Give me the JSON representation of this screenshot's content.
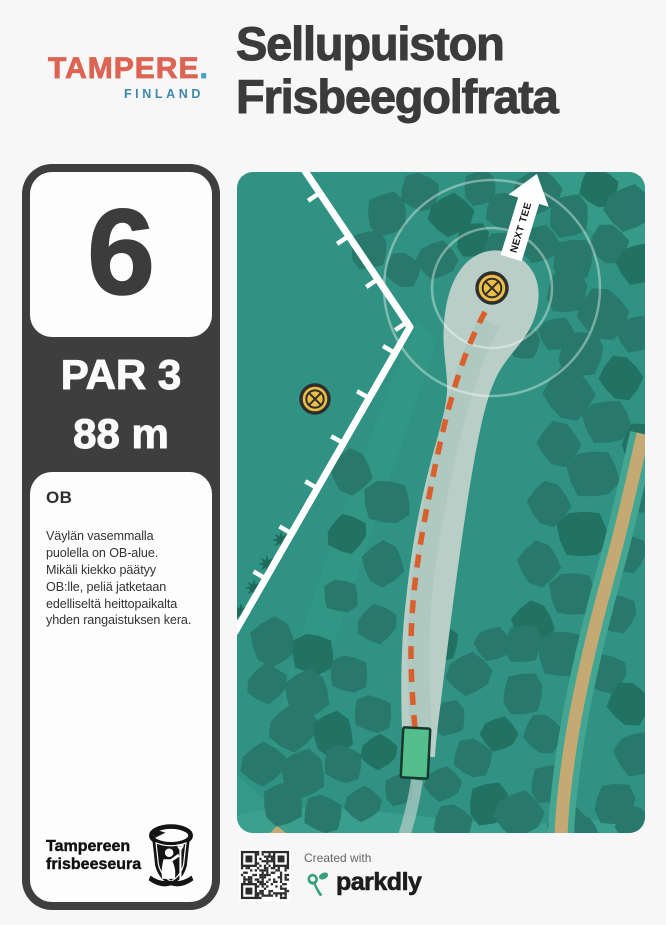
{
  "header": {
    "logo": {
      "wordmark": "TAMPERE",
      "dot": ".",
      "subtitle": "FINLAND",
      "wordmark_color": "#DD6453",
      "dot_color": "#46A0C6",
      "subtitle_color": "#3E88AE"
    },
    "title": "Sellupuiston\nFrisbeegolfrata"
  },
  "hole": {
    "number": "6",
    "par": "PAR 3",
    "distance": "88 m"
  },
  "ob": {
    "heading": "OB",
    "body": "Väylän vasemmalla\npuolella on OB-alue.\nMikäli kiekko päätyy\nOB:lle, peliä jatketaan\nedelliseltä heittopaikalta\nyhden rangaistuksen kera."
  },
  "club": {
    "name": "Tampereen\nfrisbeeseura"
  },
  "footer": {
    "created_with": "Created with",
    "brand": "parkdly",
    "brand_color": "#3BA07E"
  },
  "map": {
    "next_tee_label": "NEXT TEE",
    "colors": {
      "bg": "#2F9282",
      "wash": "#3EA190",
      "tree": "#28796B",
      "tree_dark": "#227263",
      "conifer": "#1D6A5B",
      "fairway": "#B8CEC7",
      "fairway_shade": "#A8C2B9",
      "path_tan": "#C5A972",
      "path_edge": "#43A693",
      "ob_line": "#FFFFFF",
      "flight": "#D9602C",
      "basket_fill": "#EDBE45",
      "basket_ring": "#2E2E2E",
      "tee_fill": "#55BE8D",
      "tee_stroke": "#17382C",
      "ring_stroke": "rgba(255,255,255,0.38)"
    },
    "washes": [
      {
        "d": "M 298 0 L 408 0 L 408 102 C 366 74 328 36 298 0 Z",
        "o": 0.5
      },
      {
        "d": "M 180 148 L 199 170 L 74 540 L 32 584 C 48 494 124 282 180 148 Z",
        "o": 0.28
      },
      {
        "d": "M 238 86 C 254 58 272 38 294 20 L 306 34 C 288 54 272 78 264 98 Z",
        "o": 0.3
      },
      {
        "d": "M -6 646 C 60 624 150 642 240 650 C 320 656 380 642 414 648 L 414 667 L -6 667 Z",
        "o": 0.75
      },
      {
        "d": "M -6 598 C 20 618 44 642 58 667 L -6 667 Z",
        "o": 0.45
      }
    ],
    "trees": [
      [
        150,
        42,
        22
      ],
      [
        183,
        20,
        20
      ],
      [
        214,
        43,
        22
      ],
      [
        243,
        16,
        18
      ],
      [
        268,
        40,
        20
      ],
      [
        300,
        20,
        24
      ],
      [
        332,
        44,
        22
      ],
      [
        362,
        16,
        20
      ],
      [
        392,
        36,
        24
      ],
      [
        132,
        78,
        20
      ],
      [
        166,
        98,
        18
      ],
      [
        200,
        88,
        20
      ],
      [
        236,
        68,
        18
      ],
      [
        266,
        82,
        22
      ],
      [
        302,
        72,
        20
      ],
      [
        336,
        88,
        22
      ],
      [
        372,
        72,
        20
      ],
      [
        402,
        92,
        22
      ],
      [
        330,
        120,
        22
      ],
      [
        366,
        142,
        26
      ],
      [
        400,
        162,
        20
      ],
      [
        344,
        182,
        24
      ],
      [
        384,
        206,
        22
      ],
      [
        320,
        162,
        18
      ],
      [
        288,
        172,
        16
      ],
      [
        332,
        222,
        26
      ],
      [
        370,
        250,
        24
      ],
      [
        404,
        270,
        20
      ],
      [
        322,
        272,
        22
      ],
      [
        356,
        302,
        26
      ],
      [
        398,
        322,
        20
      ],
      [
        312,
        332,
        22
      ],
      [
        346,
        362,
        26
      ],
      [
        390,
        382,
        20
      ],
      [
        302,
        392,
        22
      ],
      [
        336,
        422,
        24
      ],
      [
        380,
        442,
        20
      ],
      [
        296,
        452,
        22
      ],
      [
        326,
        482,
        26
      ],
      [
        370,
        502,
        20
      ],
      [
        114,
        300,
        22
      ],
      [
        150,
        330,
        24
      ],
      [
        110,
        362,
        20
      ],
      [
        146,
        392,
        22
      ],
      [
        104,
        424,
        18
      ],
      [
        140,
        452,
        20
      ],
      [
        36,
        470,
        24
      ],
      [
        76,
        482,
        22
      ],
      [
        30,
        512,
        20
      ],
      [
        70,
        522,
        24
      ],
      [
        112,
        502,
        20
      ],
      [
        56,
        556,
        24
      ],
      [
        96,
        562,
        22
      ],
      [
        136,
        542,
        20
      ],
      [
        26,
        592,
        22
      ],
      [
        66,
        602,
        24
      ],
      [
        106,
        592,
        20
      ],
      [
        142,
        580,
        18
      ],
      [
        46,
        632,
        22
      ],
      [
        86,
        642,
        20
      ],
      [
        126,
        632,
        18
      ],
      [
        162,
        618,
        16
      ],
      [
        202,
        470,
        20
      ],
      [
        232,
        502,
        22
      ],
      [
        212,
        546,
        18
      ],
      [
        236,
        586,
        20
      ],
      [
        206,
        612,
        18
      ],
      [
        252,
        632,
        22
      ],
      [
        216,
        652,
        20
      ],
      [
        282,
        642,
        24
      ],
      [
        312,
        612,
        20
      ],
      [
        330,
        650,
        20
      ],
      [
        262,
        562,
        18
      ],
      [
        286,
        522,
        22
      ],
      [
        306,
        562,
        20
      ],
      [
        256,
        472,
        18
      ],
      [
        286,
        472,
        20
      ],
      [
        392,
        532,
        22
      ],
      [
        402,
        582,
        24
      ],
      [
        378,
        632,
        22
      ],
      [
        398,
        654,
        20
      ],
      [
        344,
        662,
        18
      ]
    ],
    "conifers": [
      [
        44,
        368
      ],
      [
        30,
        392
      ],
      [
        17,
        416
      ],
      [
        4,
        440
      ]
    ],
    "tan_path": {
      "d": "M 406 262 C 398 296 388 344 372 402 C 356 460 342 520 334 570 C 328 610 325 636 324 664",
      "w": 13,
      "edge_w": 26
    },
    "tan_corner": {
      "d": "M 26 668 L 40 654 L 58 668 Z"
    },
    "tee_trail": {
      "d": "M 180 608 C 177 628 173 646 167 664",
      "w": 12,
      "o": 0.7
    },
    "fairway": {
      "d": "M 166 585 C 163 520 164 468 169 428 C 175 368 186 318 197 278 C 206 246 211 228 210 210 C 209 190 205 172 207 152 C 209 120 220 92 242 82 C 264 72 288 84 297 102 C 305 118 302 140 292 158 C 282 176 268 186 258 208 C 246 234 238 282 230 332 C 221 392 212 462 206 512 C 202 546 199 566 198 585 Z"
    },
    "fairway_shade": {
      "d": "M 184 560 C 178 470 182 410 198 330 C 208 280 224 205 252 150",
      "w": 22,
      "o": 0.55
    },
    "rings": [
      60,
      108
    ],
    "ob": {
      "points": [
        [
          66,
          -4
        ],
        [
          173,
          155
        ],
        [
          -2,
          460
        ]
      ],
      "width": 7,
      "tick_len": 14,
      "tick_gap": 52,
      "tick_start": 30
    },
    "flight": {
      "d": "M 178 556 C 170 470 174 420 190 335 C 200 285 215 200 248 140",
      "w": 5.5,
      "dash": "13 10"
    },
    "tee": {
      "x": 165,
      "y": 556,
      "w": 27,
      "h": 50,
      "rot": 3
    },
    "basket": {
      "x": 255,
      "y": 116,
      "r": 15
    },
    "basket2": {
      "x": 78,
      "y": 227,
      "r": 14
    },
    "arrow": {
      "x": 287,
      "y": 44,
      "rot": 17
    }
  }
}
